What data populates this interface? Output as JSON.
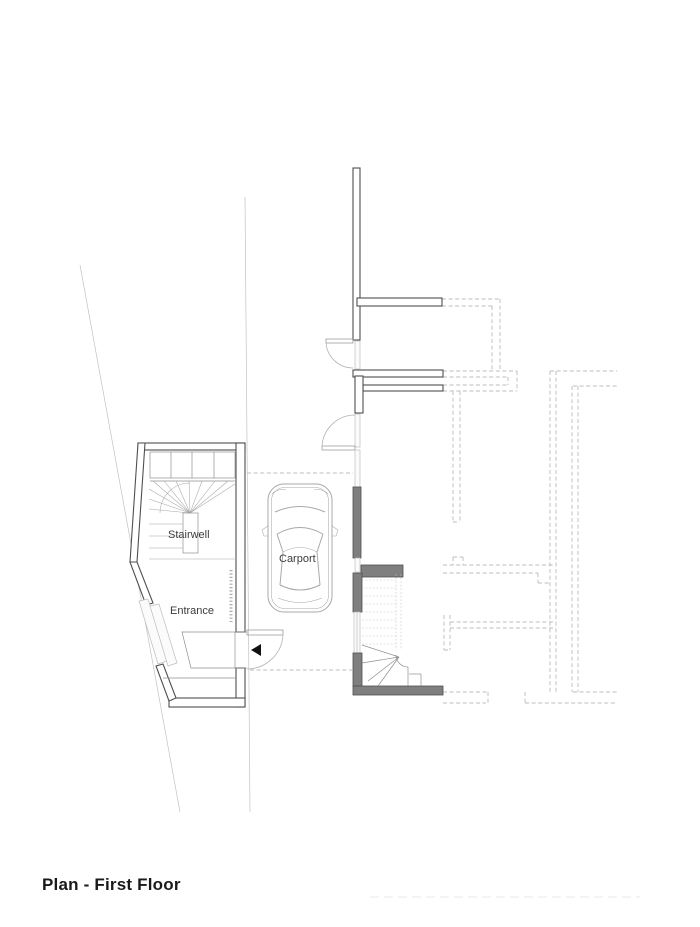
{
  "page": {
    "background": "#ffffff",
    "kind": "architectural floor plan drawing"
  },
  "title": {
    "text": "Plan - First Floor"
  },
  "labels": {
    "stairwell": "Stairwell",
    "entrance": "Entrance",
    "carport": "Carport"
  },
  "colors": {
    "background": "#ffffff",
    "wall": "#4f4f4f",
    "wall_fill": "#7f7f7f",
    "thin": "#8f8f8f",
    "dashed": "#bcbcbc",
    "site": "#c2c2c2",
    "text": "#3c3c3c",
    "title_text": "#1a1a1a",
    "arrow": "#111111"
  }
}
